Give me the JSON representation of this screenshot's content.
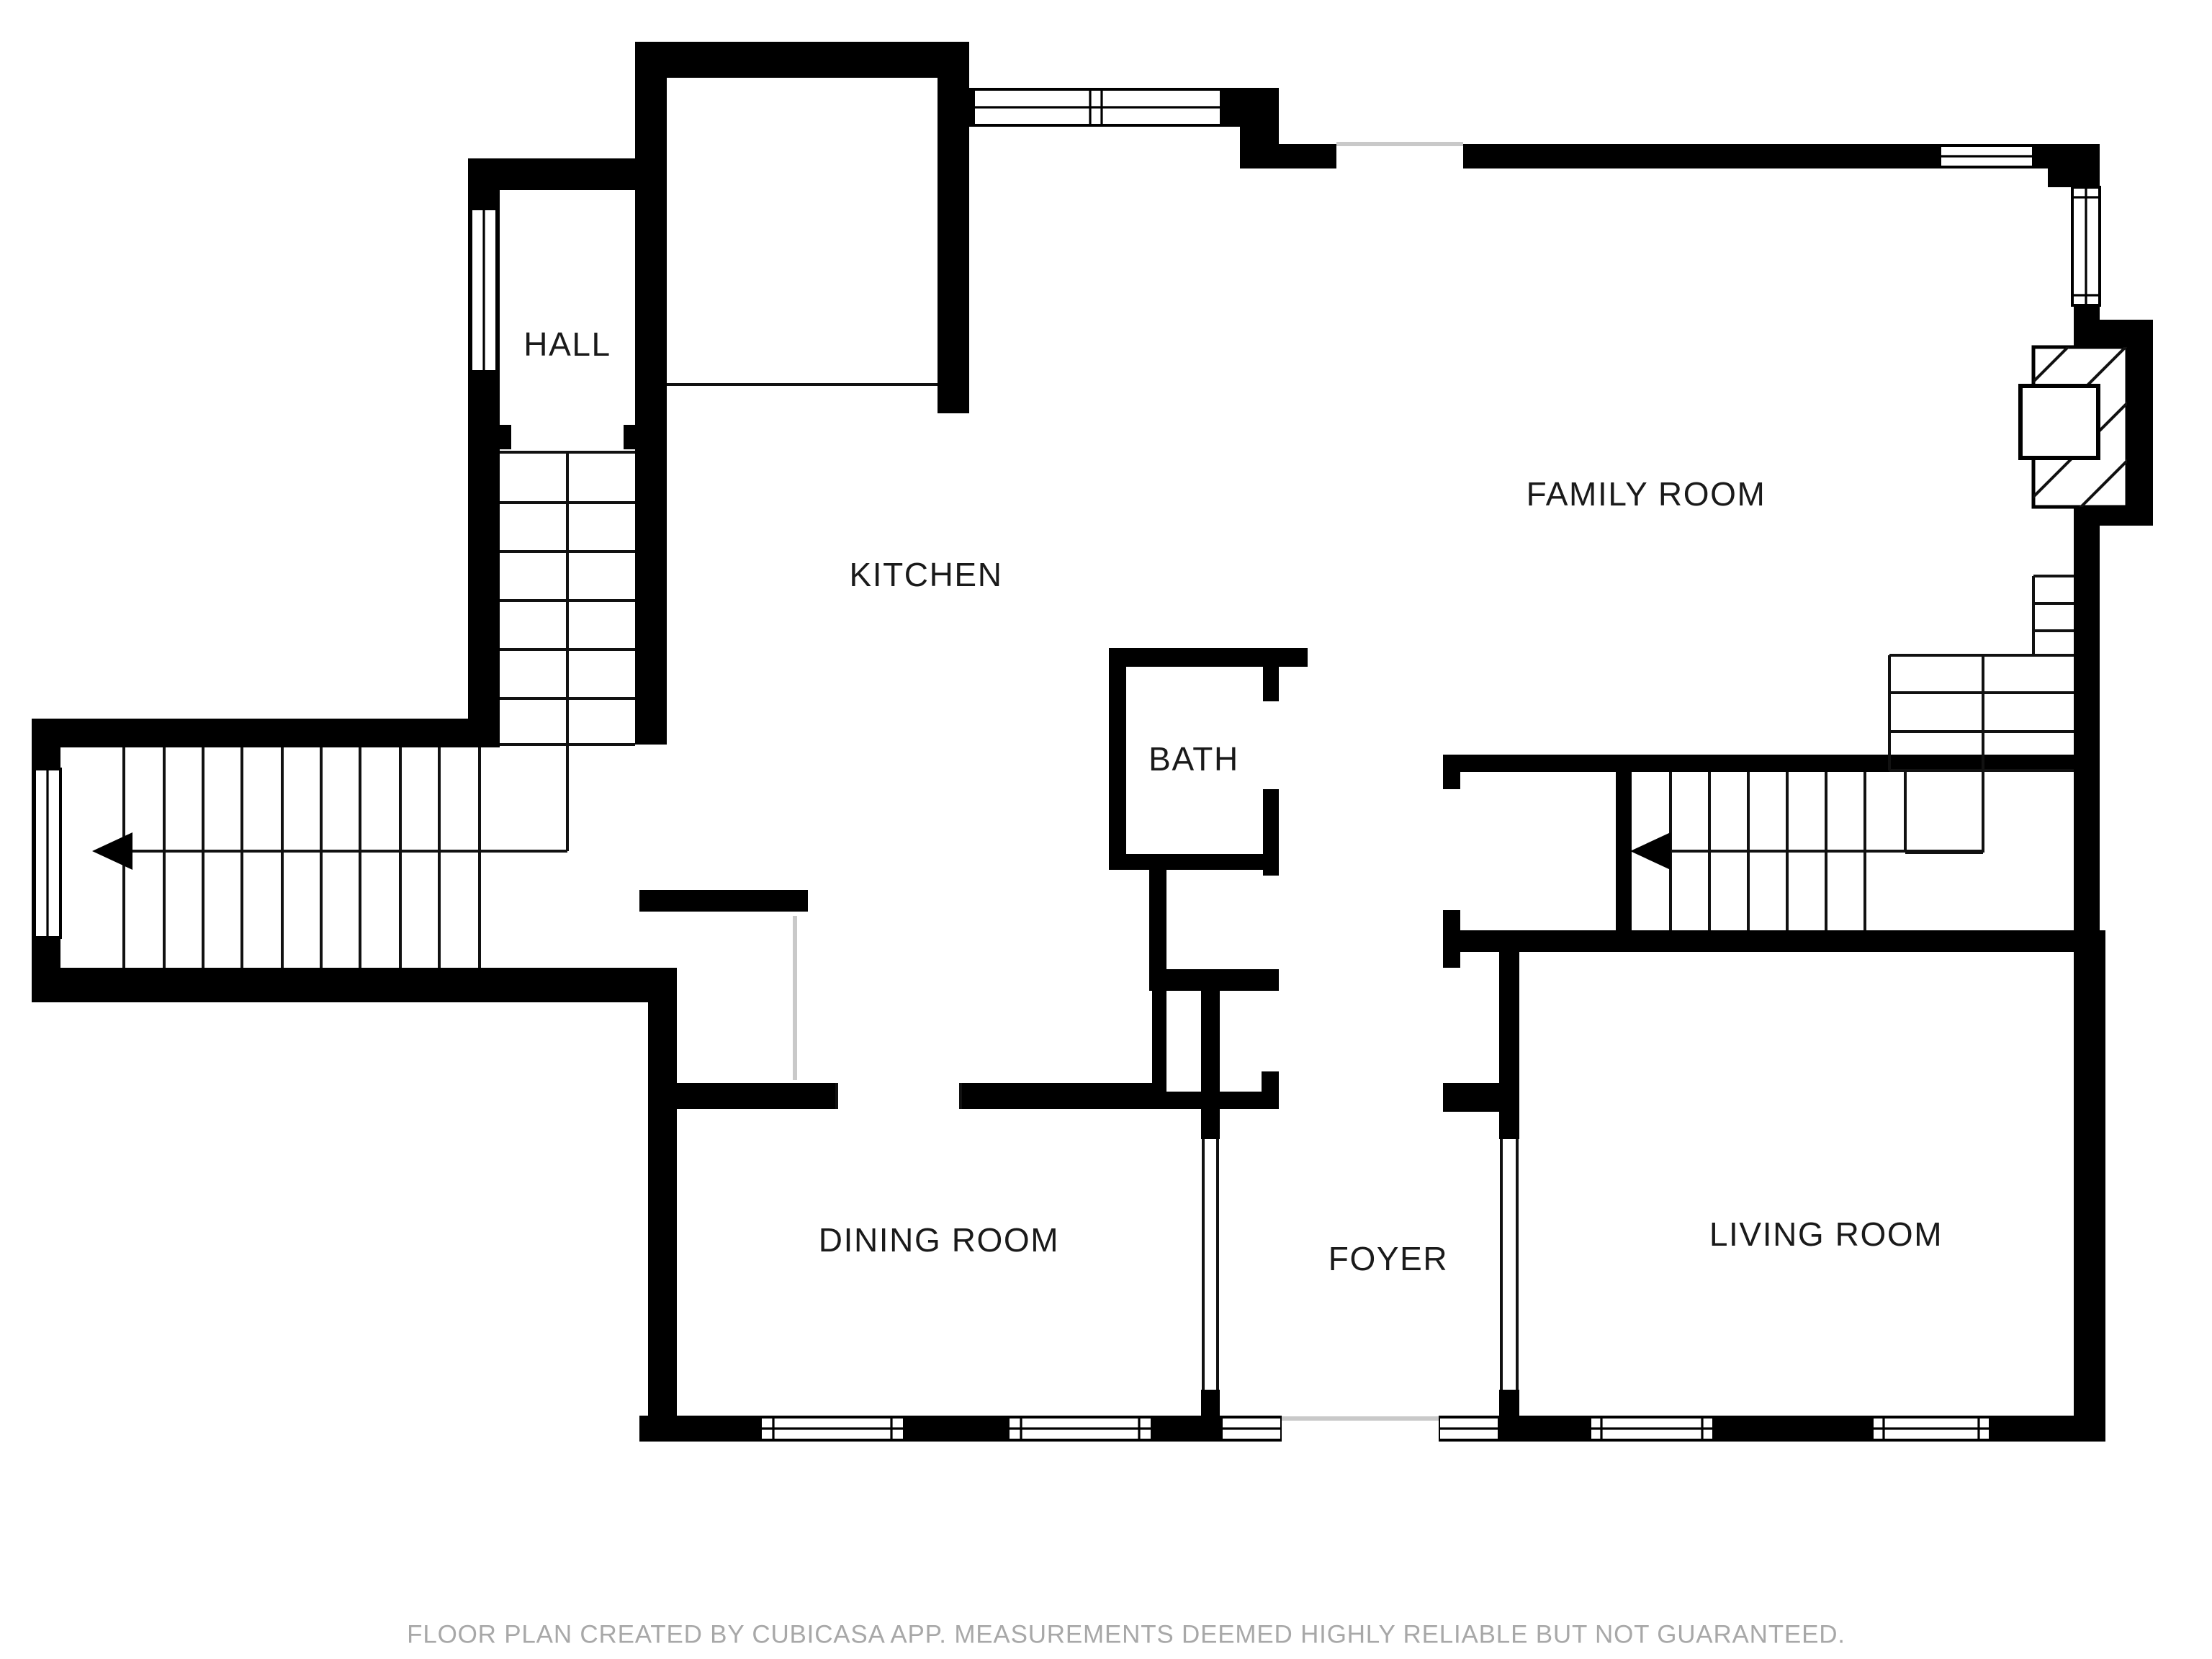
{
  "rooms": [
    {
      "id": "hall",
      "label": "HALL"
    },
    {
      "id": "kitchen",
      "label": "KITCHEN"
    },
    {
      "id": "family-room",
      "label": "FAMILY ROOM"
    },
    {
      "id": "bath",
      "label": "BATH"
    },
    {
      "id": "dining-room",
      "label": "DINING ROOM"
    },
    {
      "id": "foyer",
      "label": "FOYER"
    },
    {
      "id": "living-room",
      "label": "LIVING ROOM"
    }
  ],
  "footer": {
    "disclaimer": "FLOOR PLAN CREATED BY CUBICASA APP. MEASUREMENTS DEEMED HIGHLY RELIABLE BUT NOT GUARANTEED."
  },
  "colors": {
    "wall": "#000000",
    "background": "#ffffff",
    "label_text": "#1a1a1a",
    "footer_text": "#a8a8a8",
    "opening_line": "#c9c9c9",
    "thin_line": "#111111"
  }
}
